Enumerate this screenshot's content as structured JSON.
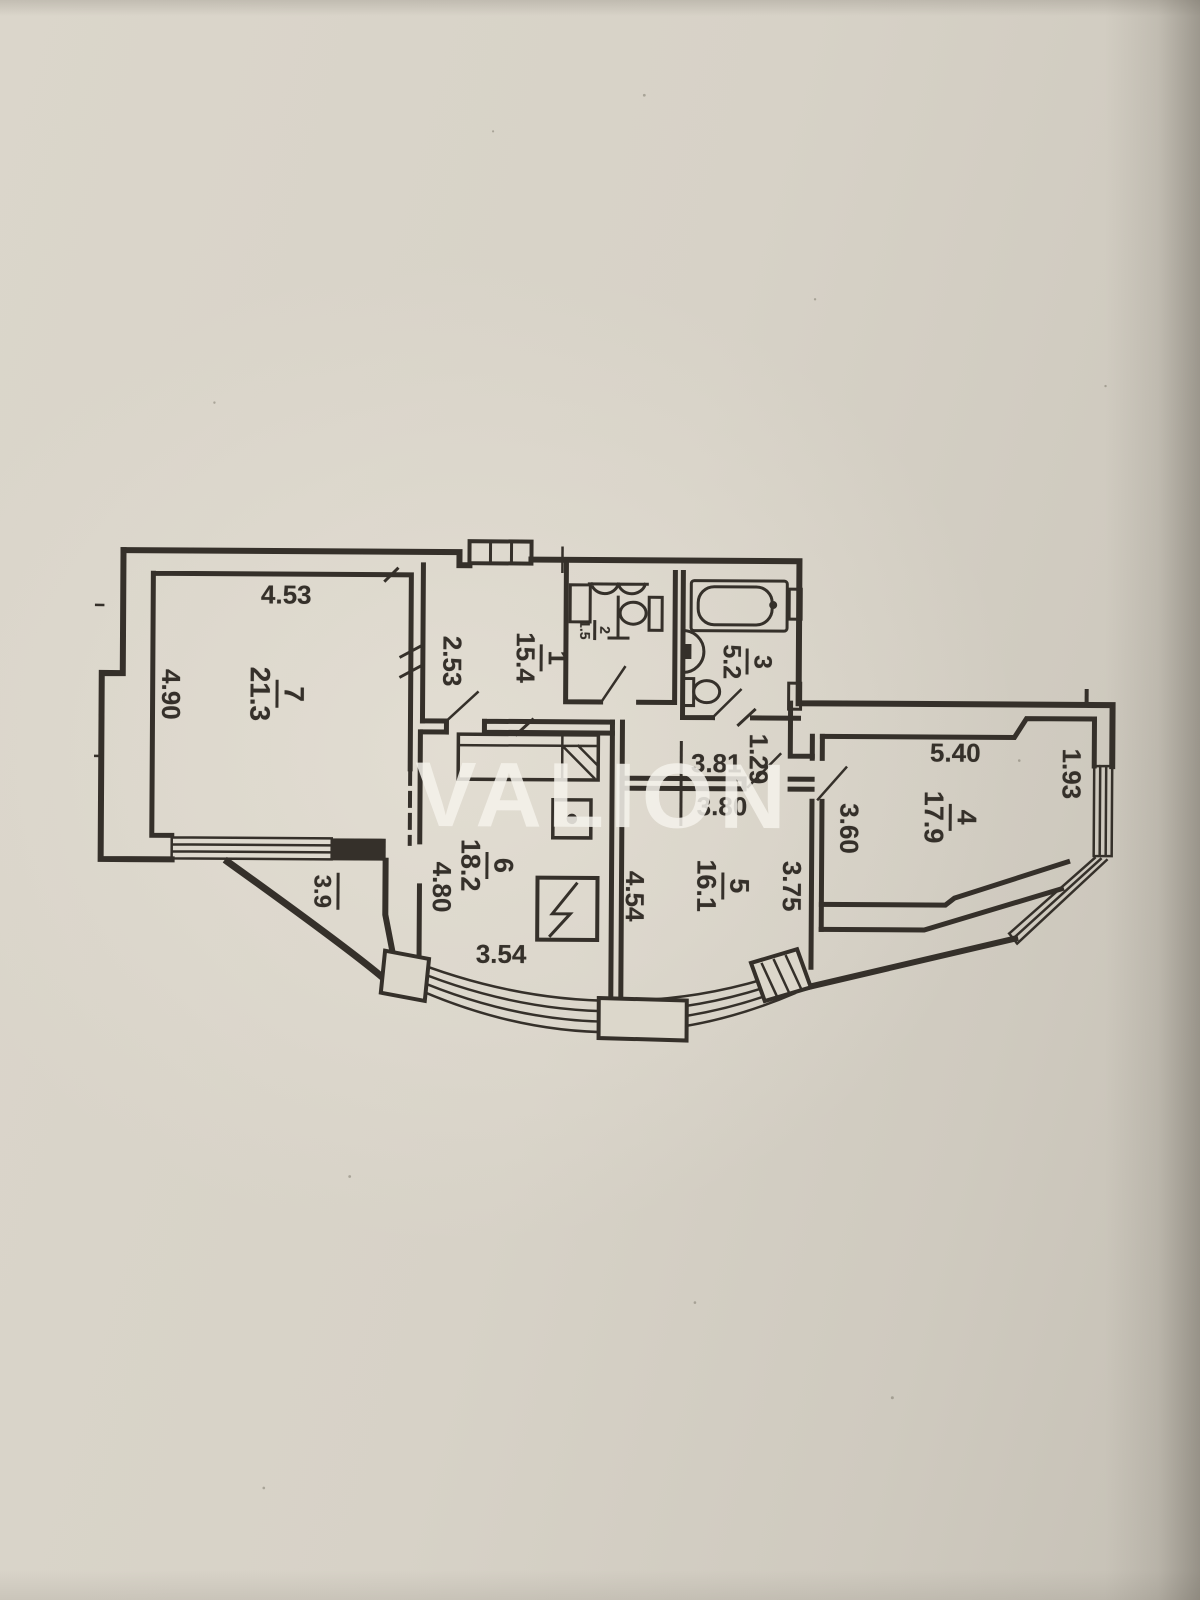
{
  "watermark": {
    "text": "VALION"
  },
  "palette": {
    "paper": "#d7d2c7",
    "paper_light": "#ddd8cc",
    "paper_edge": "#b3aea3",
    "ink": "#35302a",
    "watermark_color": "rgba(245,242,235,0.85)"
  },
  "plan": {
    "type": "apartment-floor-plan",
    "fixtures": [
      "bathtub-icon",
      "toilet-icon",
      "sink-icon",
      "wardrobe-icon",
      "electric-panel-icon",
      "stove-icon",
      "bay-window",
      "balcony-wall"
    ],
    "room_labels": [
      {
        "name": "7",
        "number": "7",
        "area": "21.3",
        "x": 276,
        "y": 696,
        "size": 28
      },
      {
        "name": "1",
        "number": "1",
        "area": "15.4",
        "x": 540,
        "y": 658,
        "size": 26
      },
      {
        "name": "2",
        "number": "2",
        "area": "1.5",
        "x": 594,
        "y": 630,
        "size": 14
      },
      {
        "name": "3",
        "number": "3",
        "area": "5.2",
        "x": 746,
        "y": 661,
        "size": 25
      },
      {
        "name": "4",
        "number": "4",
        "area": "17.9",
        "x": 950,
        "y": 815,
        "size": 27
      },
      {
        "name": "5",
        "number": "5",
        "area": "16.1",
        "x": 723,
        "y": 885,
        "size": 27
      },
      {
        "name": "6",
        "number": "6",
        "area": "18.2",
        "x": 487,
        "y": 866,
        "size": 27
      },
      {
        "name": "balcony",
        "number": "",
        "area": "3.9",
        "x": 325,
        "y": 893,
        "size": 24
      }
    ],
    "dim_labels": [
      {
        "text": "4.53",
        "x": 285,
        "y": 597,
        "rotated": false
      },
      {
        "text": "4.90",
        "x": 170,
        "y": 697,
        "rotated": true
      },
      {
        "text": "2.53",
        "x": 451,
        "y": 662,
        "rotated": true
      },
      {
        "text": "3.81",
        "x": 716,
        "y": 763,
        "rotated": false
      },
      {
        "text": "3.80",
        "x": 722,
        "y": 806,
        "rotated": false
      },
      {
        "text": "1.29",
        "x": 758,
        "y": 758,
        "rotated": true
      },
      {
        "text": "5.40",
        "x": 955,
        "y": 751,
        "rotated": false
      },
      {
        "text": "3.60",
        "x": 849,
        "y": 827,
        "rotated": true
      },
      {
        "text": "1.93",
        "x": 1071,
        "y": 771,
        "rotated": true
      },
      {
        "text": "3.75",
        "x": 792,
        "y": 885,
        "rotated": true
      },
      {
        "text": "4.54",
        "x": 635,
        "y": 896,
        "rotated": true
      },
      {
        "text": "4.80",
        "x": 442,
        "y": 888,
        "rotated": true
      },
      {
        "text": "3.54",
        "x": 502,
        "y": 955,
        "rotated": false
      }
    ]
  }
}
